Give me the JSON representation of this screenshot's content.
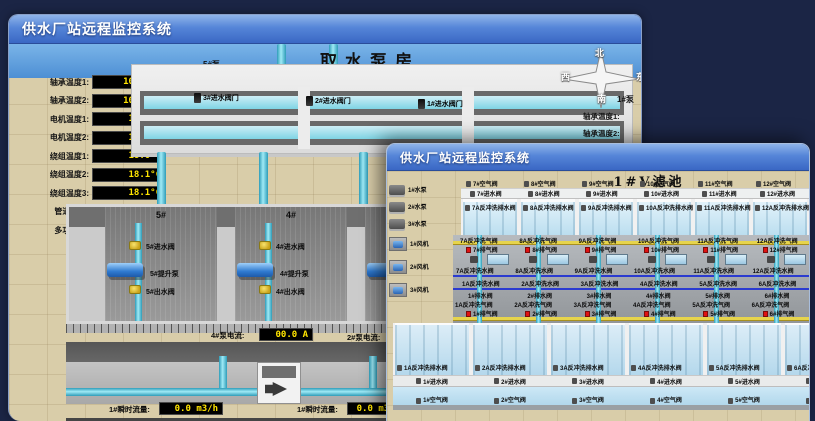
{
  "colors": {
    "desktop_bg": "#1b2545",
    "titlebar_top": "#8fb4ea",
    "titlebar_bottom": "#3a67c4",
    "value_text": "#ffe400",
    "value_bg": "#000000",
    "alarm_red": "#e01212",
    "pipe_cyan": "#5fd0e6",
    "pipe_yellow": "#e6d44c",
    "pool_blue": "#cfe9f5",
    "ground_tan": "#d9cda9"
  },
  "back_window": {
    "title": "供水厂站远程监控系统",
    "scene_title": "取水泵房",
    "pump5_panel": {
      "header": "5#泵",
      "readings": [
        {
          "label": "轴承温度1:",
          "value": "100.0°C"
        },
        {
          "label": "轴承温度2:",
          "value": "100.0°C"
        },
        {
          "label": "电机温度1:",
          "value": "18.1°C"
        },
        {
          "label": "电机温度2:",
          "value": "17.9°C"
        },
        {
          "label": "绕组温度1:",
          "value": "18.0°C"
        },
        {
          "label": "绕组温度2:",
          "value": "18.1°C"
        },
        {
          "label": "绕组温度3:",
          "value": "18.1°C"
        },
        {
          "label": "管道压力:",
          "value": "0.0007MPa"
        },
        {
          "label": "多功能阀:",
          "value": "0%"
        }
      ]
    },
    "intake_valves": [
      "3#进水阀门",
      "2#进水阀门",
      "1#进水阀门"
    ],
    "compass": {
      "north": "北",
      "south": "南",
      "west": "西",
      "east": "东"
    },
    "pump1_panel": {
      "header": "1#泵",
      "labels": [
        "轴承温度1:",
        "轴承温度2:"
      ]
    },
    "pump_bays": [
      {
        "bay": "5#",
        "inlet_valve": "5#进水阀",
        "pump": "5#提升泵",
        "outlet_valve": "5#出水阀"
      },
      {
        "bay": "4#",
        "inlet_valve": "4#进水阀",
        "pump": "4#提升泵",
        "outlet_valve": "4#出水阀"
      },
      {
        "bay": "3#",
        "inlet_valve": "3#进水阀",
        "pump": "3#提升泵",
        "outlet_valve": "3#出水阀"
      }
    ],
    "current_readings": [
      {
        "label": "4#泵电流:",
        "value": "00.0 A"
      },
      {
        "label": "2#泵电流:",
        "value": ""
      }
    ],
    "flow_readings": [
      {
        "label": "1#瞬时流量:",
        "value": "0.0 m3/h"
      },
      {
        "label": "1#瞬时流量:",
        "value": "0.0 m3/h"
      }
    ]
  },
  "front_window": {
    "title": "供水厂站远程监控系统",
    "scene_title": "1#V滤池",
    "pumps": [
      "1#水泵",
      "2#水泵",
      "3#水泵"
    ],
    "blowers": [
      "1#风机",
      "2#风机",
      "3#风机"
    ],
    "upper_filters": [
      {
        "air_valve": "7#空气阀",
        "inlet_valve": "7#进水阀",
        "drain_valve": "7A反冲洗排水阀"
      },
      {
        "air_valve": "8#空气阀",
        "inlet_valve": "8#进水阀",
        "drain_valve": "8A反冲洗排水阀"
      },
      {
        "air_valve": "9#空气阀",
        "inlet_valve": "9#进水阀",
        "drain_valve": "9A反冲洗排水阀"
      },
      {
        "air_valve": "10#空气阀",
        "inlet_valve": "10#进水阀",
        "drain_valve": "10A反冲洗排水阀"
      },
      {
        "air_valve": "11#空气阀",
        "inlet_valve": "11#进水阀",
        "drain_valve": "11A反冲洗排水阀"
      },
      {
        "air_valve": "12#空气阀",
        "inlet_valve": "12#进水阀",
        "drain_valve": "12A反冲洗排水阀"
      }
    ],
    "gallery_columns": [
      {
        "upper_air": "7A反冲洗气阀",
        "upper_exhaust": "7#排气阀",
        "upper_wash": "7A反冲洗水阀",
        "lower_wash": "1A反冲洗水阀",
        "lower_drain": "1#排水阀",
        "lower_air": "1A反冲洗气阀",
        "lower_exhaust": "1#排气阀"
      },
      {
        "upper_air": "8A反冲洗气阀",
        "upper_exhaust": "8#排气阀",
        "upper_wash": "8A反冲洗水阀",
        "lower_wash": "2A反冲洗水阀",
        "lower_drain": "2#排水阀",
        "lower_air": "2A反冲洗气阀",
        "lower_exhaust": "2#排气阀"
      },
      {
        "upper_air": "9A反冲洗气阀",
        "upper_exhaust": "9#排气阀",
        "upper_wash": "9A反冲洗水阀",
        "lower_wash": "3A反冲洗水阀",
        "lower_drain": "3#排水阀",
        "lower_air": "3A反冲洗气阀",
        "lower_exhaust": "3#排气阀"
      },
      {
        "upper_air": "10A反冲洗气阀",
        "upper_exhaust": "10#排气阀",
        "upper_wash": "10A反冲洗水阀",
        "lower_wash": "4A反冲洗水阀",
        "lower_drain": "4#排水阀",
        "lower_air": "4A反冲洗气阀",
        "lower_exhaust": "4#排气阀"
      },
      {
        "upper_air": "11A反冲洗气阀",
        "upper_exhaust": "11#排气阀",
        "upper_wash": "11A反冲洗水阀",
        "lower_wash": "5A反冲洗水阀",
        "lower_drain": "5#排水阀",
        "lower_air": "5A反冲洗气阀",
        "lower_exhaust": "5#排气阀"
      },
      {
        "upper_air": "12A反冲洗气阀",
        "upper_exhaust": "12#排气阀",
        "upper_wash": "12A反冲洗水阀",
        "lower_wash": "6A反冲洗水阀",
        "lower_drain": "6#排水阀",
        "lower_air": "6A反冲洗气阀",
        "lower_exhaust": "6#排气阀"
      }
    ],
    "lower_filters": [
      {
        "drain_valve": "1A反冲洗排水阀",
        "inlet_valve": "1#进水阀",
        "air_valve": "1#空气阀"
      },
      {
        "drain_valve": "2A反冲洗排水阀",
        "inlet_valve": "2#进水阀",
        "air_valve": "2#空气阀"
      },
      {
        "drain_valve": "3A反冲洗排水阀",
        "inlet_valve": "3#进水阀",
        "air_valve": "3#空气阀"
      },
      {
        "drain_valve": "4A反冲洗排水阀",
        "inlet_valve": "4#进水阀",
        "air_valve": "4#空气阀"
      },
      {
        "drain_valve": "5A反冲洗排水阀",
        "inlet_valve": "5#进水阀",
        "air_valve": "5#空气阀"
      },
      {
        "drain_valve": "6A反冲洗排水阀",
        "inlet_valve": "6#进水阀",
        "air_valve": "6#空气阀"
      }
    ]
  }
}
